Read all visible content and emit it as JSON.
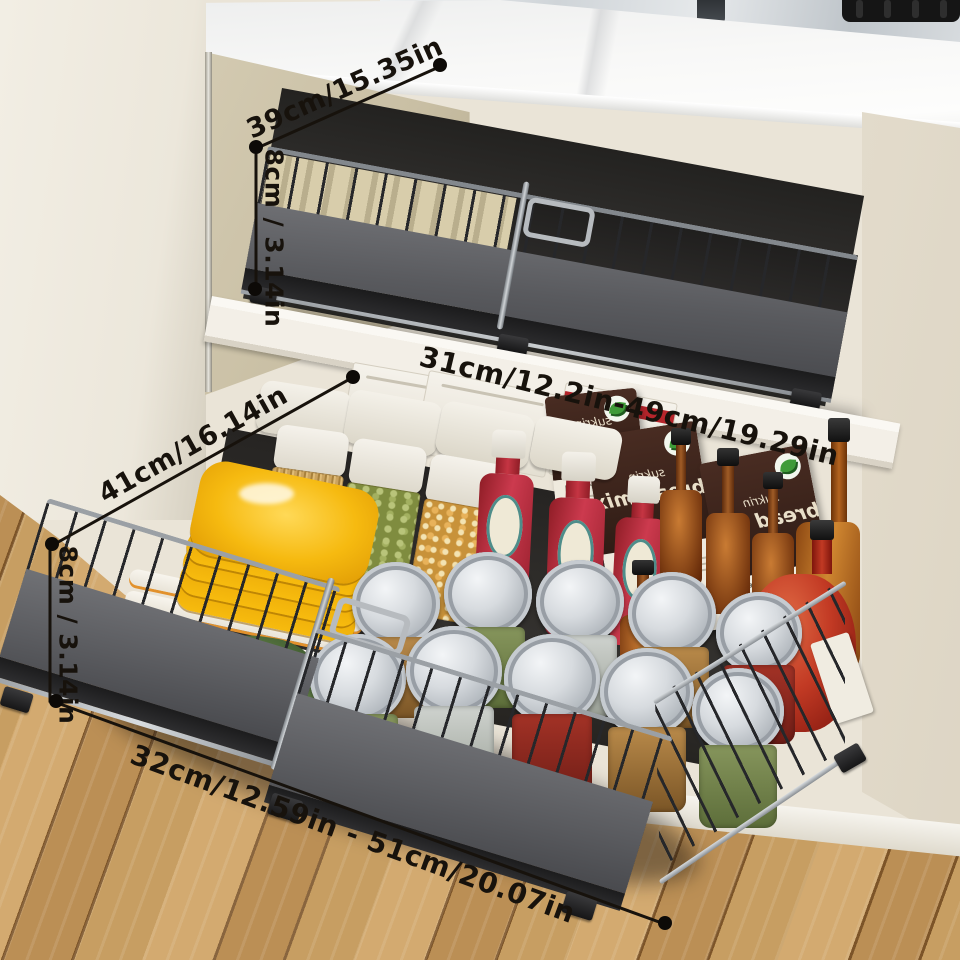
{
  "annotations": {
    "top_width": "39cm/15.35in",
    "top_height": "8cm / 3.14in",
    "middle_depth_range": "31cm/12.2in-49cm/19.29in",
    "drawer_depth": "41cm/16.14in",
    "drawer_height": "8cm / 3.14in",
    "drawer_width_range": "32cm/12.59in - 51cm/20.07in"
  },
  "products": {
    "bread_mix_brand": "sukrin",
    "bread_mix_name": "bread mix",
    "bread_mix_subtitle": "Sunflower Seed",
    "mix_box_label": "MIX"
  },
  "colors": {
    "annotation_ink": "#17120c",
    "cabinet_cream": "#eae4d7",
    "cabinet_tan_panel": "#c9bfa4",
    "marble_counter": "#f5f5f4",
    "cabinet_interior": "#2d2b28",
    "basket_gray": "#5b5c5f",
    "chrome_rail": "#c3c7cb",
    "wire_black": "#26272a",
    "shelf_white": "#f3efe7",
    "wood_floor": "#c79e62",
    "plate_yellow": "#f6ba10",
    "plate_rim_orange": "#e2912c",
    "ketchup_red": "#bf3040",
    "amber_bottle": "#8a4617",
    "package_brown": "#38241d",
    "leaf_green": "#3f9b38"
  }
}
